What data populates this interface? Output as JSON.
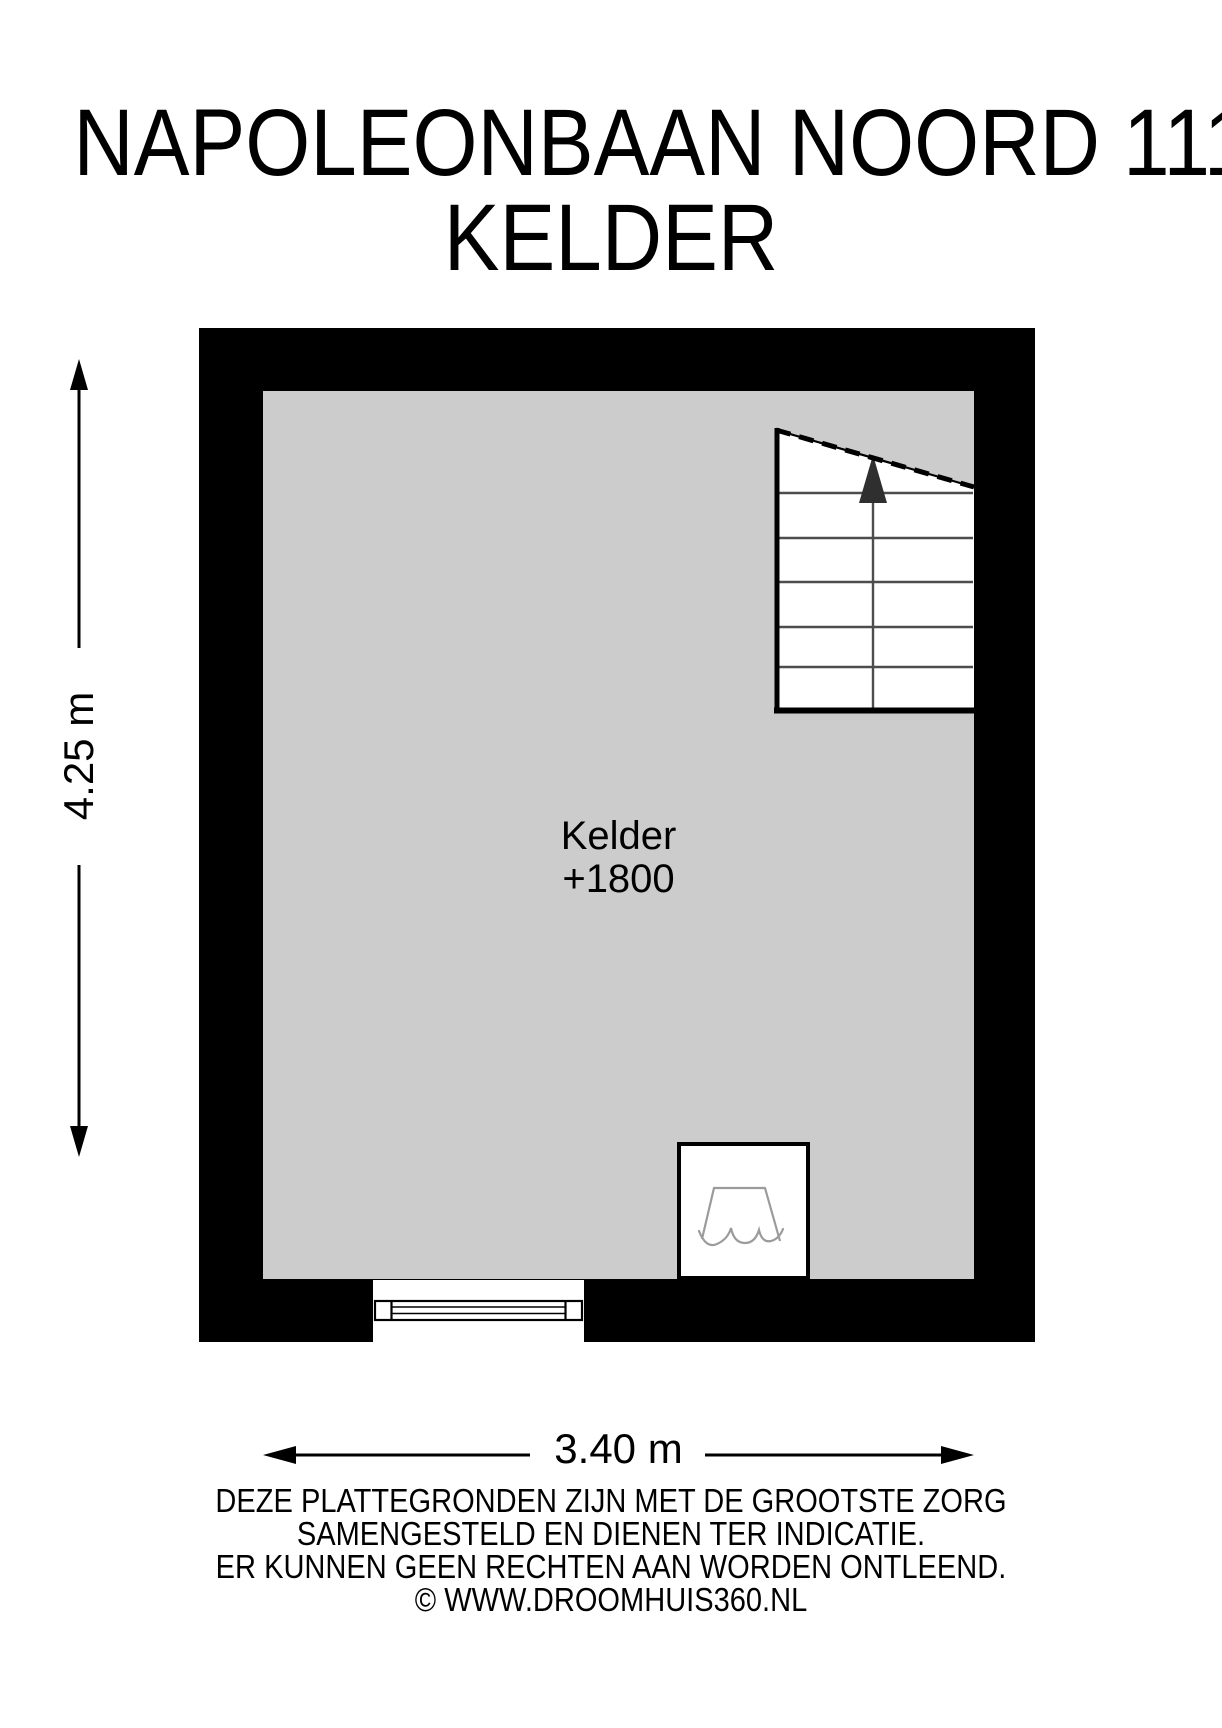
{
  "title": {
    "line1": "NAPOLEONBAAN NOORD 111",
    "line2": "KELDER"
  },
  "plan": {
    "room_label": "Kelder",
    "room_elevation": "+1800",
    "symbols": [
      "staircase-up",
      "window",
      "sink-fixture"
    ]
  },
  "dimensions": {
    "vertical": "4.25 m",
    "horizontal": "3.40 m"
  },
  "disclaimer": {
    "lines": [
      "DEZE PLATTEGRONDEN ZIJN MET DE GROOTSTE ZORG",
      "SAMENGESTELD EN DIENEN TER INDICATIE.",
      "ER KUNNEN GEEN RECHTEN AAN WORDEN ONTLEEND.",
      "© WWW.DROOMHUIS360.NL"
    ]
  },
  "colors": {
    "wall": "#000000",
    "floor": "#cccccc",
    "background": "#ffffff",
    "stair_line": "#4d4d4d",
    "fixture_line": "#9b9b9b"
  }
}
